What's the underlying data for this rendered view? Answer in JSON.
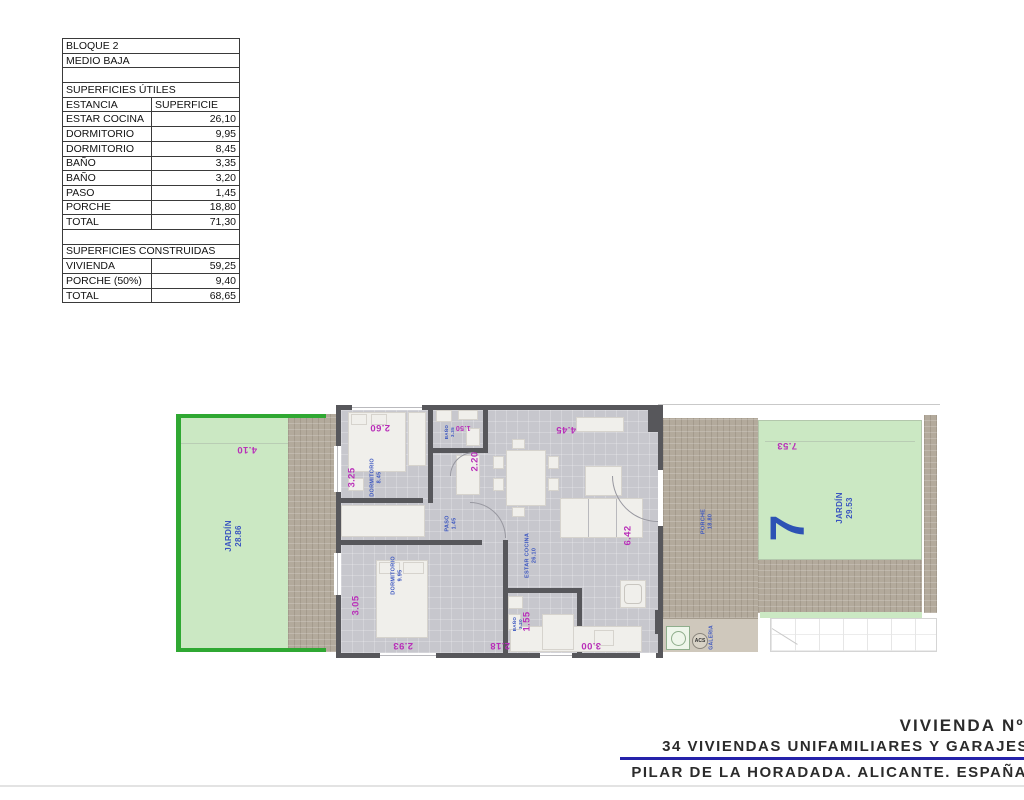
{
  "table": {
    "rows": [
      {
        "type": "span",
        "label": "BLOQUE 2"
      },
      {
        "type": "span",
        "label": "MEDIO BAJA"
      },
      {
        "type": "gap"
      },
      {
        "type": "span",
        "label": "SUPERFICIES ÚTILES"
      },
      {
        "type": "header",
        "label": "ESTANCIA",
        "value": "SUPERFICIE"
      },
      {
        "type": "data",
        "label": "ESTAR COCINA",
        "value": "26,10"
      },
      {
        "type": "data",
        "label": "DORMITORIO",
        "value": "9,95"
      },
      {
        "type": "data",
        "label": "DORMITORIO",
        "value": "8,45"
      },
      {
        "type": "data",
        "label": "BAÑO",
        "value": "3,35"
      },
      {
        "type": "data",
        "label": "BAÑO",
        "value": "3,20"
      },
      {
        "type": "data",
        "label": "PASO",
        "value": "1,45"
      },
      {
        "type": "data",
        "label": "PORCHE",
        "value": "18,80"
      },
      {
        "type": "data",
        "label": "TOTAL",
        "value": "71,30"
      },
      {
        "type": "gap"
      },
      {
        "type": "span",
        "label": "SUPERFICIES CONSTRUIDAS"
      },
      {
        "type": "data",
        "label": "VIVIENDA",
        "value": "59,25"
      },
      {
        "type": "data",
        "label": "PORCHE (50%)",
        "value": "9,40"
      },
      {
        "type": "data",
        "label": "TOTAL",
        "value": "68,65"
      }
    ]
  },
  "plan": {
    "garden_left": {
      "name": "JARDÍN",
      "area": "28.86",
      "dim_top": "4.10"
    },
    "garden_right": {
      "name": "JARDÍN",
      "area": "29.53",
      "dim_top": "7.53",
      "unit_number": "7"
    },
    "porch": {
      "name": "PORCHE",
      "area": "18.80"
    },
    "galeria": {
      "name": "GALERIA",
      "acs": "ACS"
    },
    "rooms": {
      "dorm1": {
        "name": "DORMITORIO",
        "area": "8.45",
        "dim_side": "3.25",
        "dim_top": "2.60"
      },
      "dorm2": {
        "name": "DORMITORIO",
        "area": "9.95",
        "dim_side": "3.05",
        "dim_bottom": "2.93"
      },
      "bath1": {
        "name": "BAÑO",
        "area": "3.35",
        "dim_top": "1.50",
        "dim_side": "2.20"
      },
      "bath2": {
        "name": "BAÑO",
        "area": "3.20",
        "dim_side": "1.55",
        "dim_bottom": "2.18"
      },
      "paso": {
        "name": "PASO",
        "area": "1.45"
      },
      "living": {
        "name": "ESTAR COCINA",
        "area": "26.10",
        "dim_top": "4.45",
        "dim_right": "6.42",
        "dim_bottom": "3.00"
      }
    }
  },
  "title_block": {
    "line1": "VIVIENDA Nº7",
    "line2": "34 VIVIENDAS UNIFAMILIARES Y GARAJES",
    "line3": "PILAR DE LA HORADADA. ALICANTE. ESPAÑA"
  },
  "colors": {
    "garden_fill": "#cbe8c3",
    "garden_border": "#2fa832",
    "tile_tan": "#b3aa9c",
    "wall_gray": "#57575b",
    "floor_gray": "#c7c7cd",
    "dim_magenta": "#b92fb9",
    "label_blue": "#3a55c0",
    "unit_blue": "#2d52b4",
    "title_ink": "#2b2b2b",
    "rule_blue": "#2522aa"
  }
}
